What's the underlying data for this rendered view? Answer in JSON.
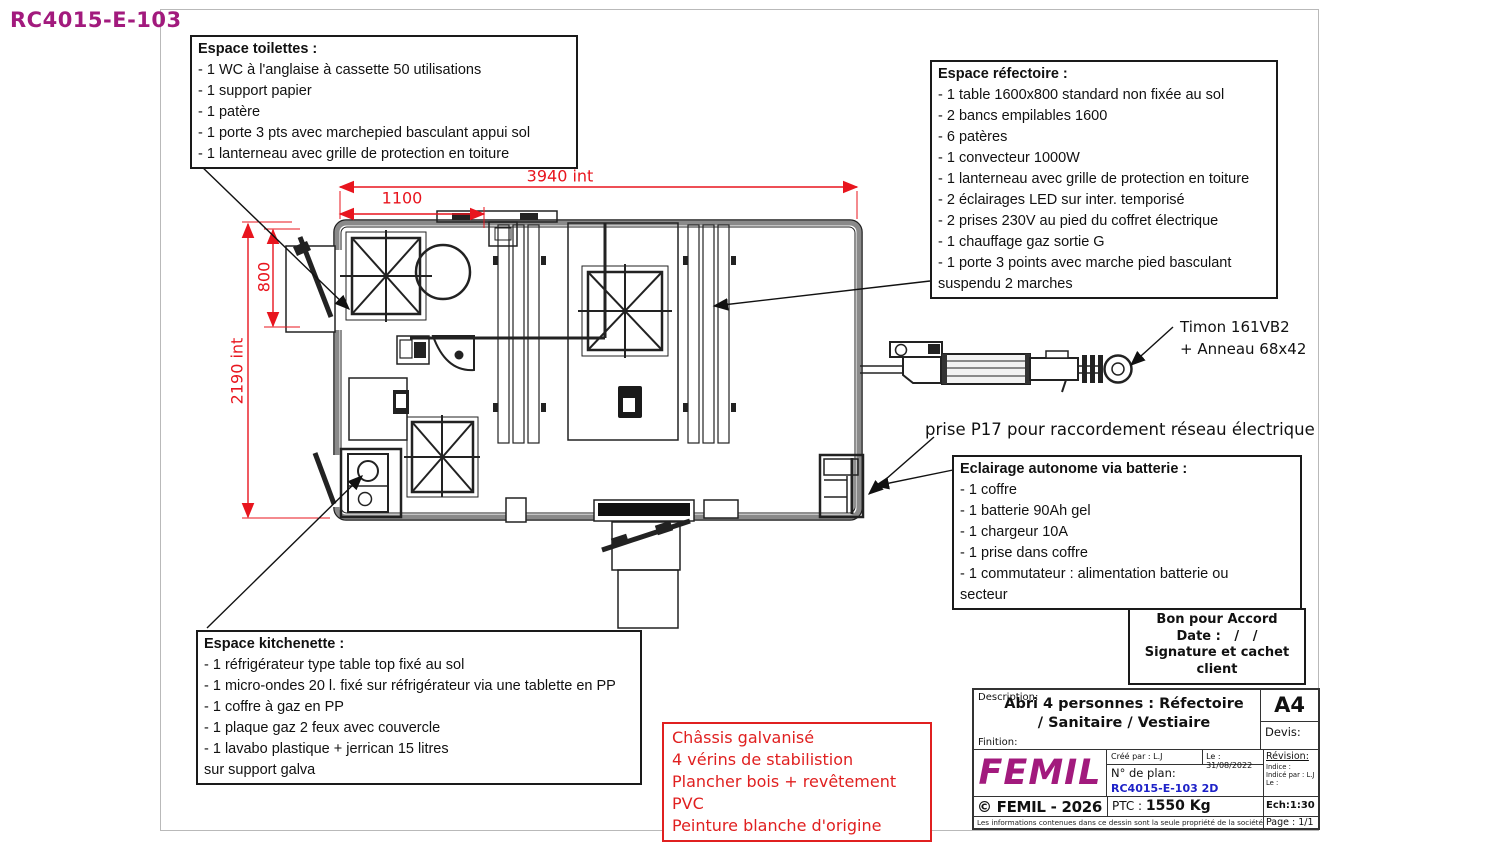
{
  "doc": {
    "ref": "RC4015-E-103"
  },
  "colors": {
    "accent": "#A21A7D",
    "dim_red": "#E8151E",
    "plan_blue": "#1E22C8",
    "red_note": "#E02020"
  },
  "notes": {
    "toilettes": {
      "title": "Espace toilettes :",
      "items": [
        "- 1 WC à l'anglaise à cassette 50 utilisations",
        "- 1 support papier",
        "- 1 patère",
        "- 1 porte 3 pts avec marchepied basculant appui sol",
        "- 1 lanterneau avec grille de protection en toiture"
      ]
    },
    "refectoire": {
      "title": "Espace réfectoire :",
      "items": [
        "- 1 table 1600x800 standard non fixée au sol",
        "- 2 bancs empilables 1600",
        "- 6 patères",
        "- 1 convecteur 1000W",
        "- 1 lanterneau avec grille de protection en toiture",
        "- 2 éclairages LED sur inter. temporisé",
        "- 2 prises 230V au pied du coffret électrique",
        "- 1 chauffage gaz sortie G",
        "- 1 porte 3 points avec marche pied basculant",
        "suspendu 2 marches"
      ]
    },
    "batterie": {
      "title": "Eclairage autonome via batterie :",
      "items": [
        "- 1 coffre",
        "- 1 batterie 90Ah gel",
        "- 1 chargeur 10A",
        "- 1 prise dans coffre",
        "- 1 commutateur : alimentation batterie ou",
        "secteur"
      ]
    },
    "kitchenette": {
      "title": "Espace kitchenette :",
      "items": [
        "- 1 réfrigérateur type table top fixé au sol",
        "- 1 micro-ondes 20 l. fixé sur réfrigérateur via une tablette en PP",
        "- 1 coffre à gaz en PP",
        "- 1 plaque gaz 2 feux avec couvercle",
        "- 1 lavabo plastique + jerrican 15 litres",
        "sur support galva"
      ]
    },
    "chassis": {
      "items": [
        "Châssis galvanisé",
        "4 vérins de stabilistion",
        "Plancher bois + revêtement PVC",
        "Peinture blanche d'origine"
      ]
    }
  },
  "callouts": {
    "timon_line1": "Timon 161VB2",
    "timon_line2": "+ Anneau 68x42",
    "prise": "prise P17 pour raccordement réseau électrique"
  },
  "dimensions": {
    "overall_width": "3940 int",
    "toilet_width": "1100",
    "alcove_depth": "800",
    "overall_depth": "2190 int"
  },
  "approval": {
    "line1": "Bon pour Accord",
    "line2": "Date :   /   /",
    "line3": "Signature et cachet client"
  },
  "titleblock": {
    "description_label": "Description:",
    "description_line1": "Abri 4 personnes : Réfectoire",
    "description_line2": "/ Sanitaire / Vestiaire",
    "format": "A4",
    "devis_label": "Devis:",
    "finition_label": "Finition:",
    "logo": "FEMIL",
    "created_by": "Créé par : L.J",
    "date": "Le : 31/08/2022",
    "revision_label": "Révision:",
    "indice_label": "Indice :",
    "indice_par": "Indicé par : L.J",
    "indice_le": "Le :",
    "plan_label": "N° de plan:",
    "plan_number": "RC4015-E-103 2D",
    "ptc_label": "PTC : ",
    "ptc_value": "1550 Kg",
    "copyright": "© FEMIL - 2026",
    "scale": "Ech:1:30",
    "disclaimer": "Les informations contenues dans ce dessin sont la seule propriété de la société",
    "page": "Page : 1/1"
  }
}
